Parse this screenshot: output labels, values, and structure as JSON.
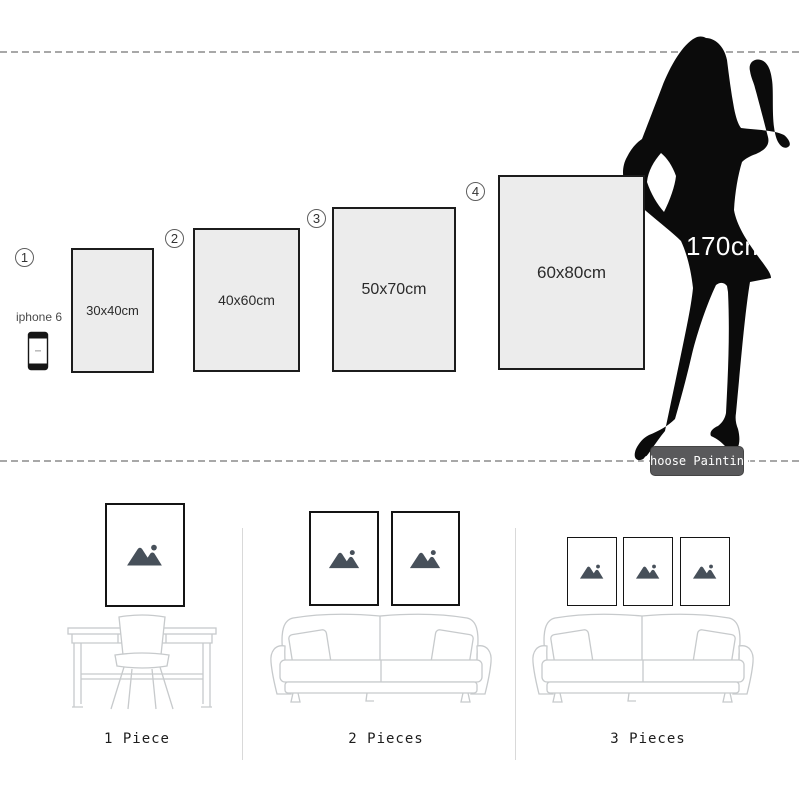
{
  "size_guide": {
    "items": [
      {
        "number": "1",
        "size": "30x40cm"
      },
      {
        "number": "2",
        "size": "40x60cm"
      },
      {
        "number": "3",
        "size": "50x70cm"
      },
      {
        "number": "4",
        "size": "60x80cm"
      }
    ],
    "phone_label": "iphone 6",
    "person_height": "170cm",
    "choose_button_label": "Choose Painting"
  },
  "scenes": [
    {
      "label": "1 Piece",
      "pieces": 1,
      "furniture": "desk-and-chair"
    },
    {
      "label": "2 Pieces",
      "pieces": 2,
      "furniture": "sofa"
    },
    {
      "label": "3 Pieces",
      "pieces": 3,
      "furniture": "sofa"
    }
  ],
  "colors": {
    "frame_fill": "#ececec",
    "frame_border": "#1c1c1c",
    "silhouette_black": "#0b0b0b",
    "button_bg": "#59595b",
    "button_text": "#ffffff",
    "furniture_line": "#c7cacc",
    "placeholder_icon": "#47505a",
    "dashed_line": "#a8a8a8",
    "divider": "#d9d9d9"
  }
}
